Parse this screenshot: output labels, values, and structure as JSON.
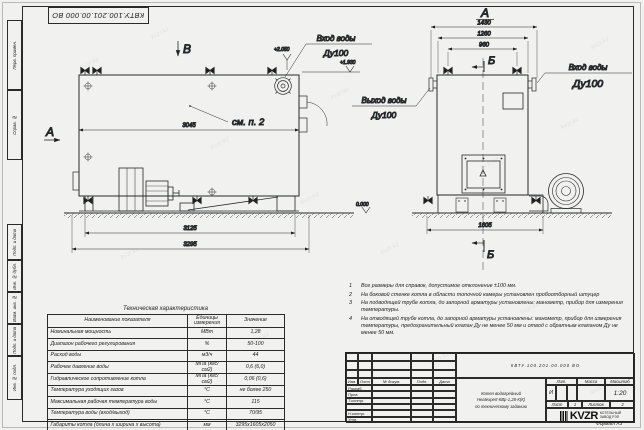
{
  "watermark_text": "kvzr.kz",
  "doc_stamp": "КВТУ.100.201.00.000 ВО",
  "margin_labels": [
    "Перв. примен.",
    "Справ. №",
    "Подп. и дата",
    "Инв. № дубл.",
    "Взам. инв. №",
    "Подп. и дата",
    "Инв. № подл."
  ],
  "side": {
    "view_letter_top": "В",
    "view_letter_left": "А",
    "see_note": "см. п. 2",
    "dim_body": "3045",
    "dim_frame": "3125",
    "dim_total": "3295",
    "inlet_label": "Вход воды",
    "inlet_dn": "Ду100",
    "elev_inlet": "+2.050",
    "elev_pipe": "+1.930",
    "elev_ground": "0.000"
  },
  "front": {
    "view_letter": "А",
    "section_letter_top": "Б",
    "section_letter_bottom": "Б",
    "dim_width_total": "1430",
    "dim_width_mid": "1260",
    "dim_width_valves": "960",
    "dim_base": "1605",
    "outlet_label": "Выход воды",
    "outlet_dn": "Ду100",
    "inlet_label": "Вход воды",
    "inlet_dn": "Ду100"
  },
  "notes": [
    {
      "num": "1",
      "text": "Все размеры для справок, допустимое отклонение ±100 мм."
    },
    {
      "num": "2",
      "text": "На боковой стенке котла в области топочной камеры установлен пробоотборный штуцер"
    },
    {
      "num": "3",
      "text": "На  подводящей трубе котла, до запорной арматуры установлены: манометр, прибор для измерения температуры."
    },
    {
      "num": "4",
      "text": "На отводящей трубе котла, до запорной арматуры установлены: манометр, прибор для измерения температуры, предохранительный клапан Ду не менее 50 мм и отвод с обратным клапаном Ду не менее 50 мм."
    }
  ],
  "table": {
    "title": "Техническая характеристика",
    "headers": [
      "Наименование показателя",
      "Единицы измерения",
      "Значение"
    ],
    "rows": [
      [
        "Номинальная мощность",
        "МВт",
        "1,28"
      ],
      [
        "Диапазон рабочего регулирования",
        "%",
        "50-100"
      ],
      [
        "Расход воды",
        "м3/ч",
        "44"
      ],
      [
        "Рабочее давление воды",
        "МПа (кгс/см2)",
        "0,6 (6,0)"
      ],
      [
        "Гидравлическое сопротивление котла",
        "МПа (кгс/см2)",
        "0,06 (0,6)"
      ],
      [
        "Температура уходящих газов",
        "°С",
        "не более 250"
      ],
      [
        "Максимальная рабочая температура воды",
        "°С",
        "115"
      ],
      [
        "Температура воды (вход/выход)",
        "°С",
        "70/95"
      ],
      [
        "Габариты котла (длина х ширина х высота)",
        "мм",
        "3295х1605х2050"
      ]
    ]
  },
  "titleblock": {
    "doc_number": "КВТУ.100.201.00.000 ВО",
    "header_cols": [
      "Изм.",
      "Лист",
      "№ докум.",
      "Подп.",
      "Дата"
    ],
    "sign_rows": [
      "Разраб.",
      "Пров.",
      "Т.контр.",
      "",
      "Н.контр.",
      "Утв."
    ],
    "product_line1": "Котел водогрейный",
    "product_line2": "Heatexpert-КВр-1,28-К(К)",
    "product_line3": "по техническому заданию",
    "lit_header": "Лит.",
    "mass_header": "Масса",
    "scale_header": "Масштаб",
    "lit_value": "И",
    "scale_value": "1:20",
    "sheet_label": "Лист",
    "sheet_value": "1",
    "sheets_label": "Листов",
    "sheets_value": "2",
    "company_logo": "KVZR",
    "company_name1": "КОТЕЛЬНЫЙ",
    "company_name2": "ЗАВОД РЭП",
    "format_label": "Формат А3"
  }
}
